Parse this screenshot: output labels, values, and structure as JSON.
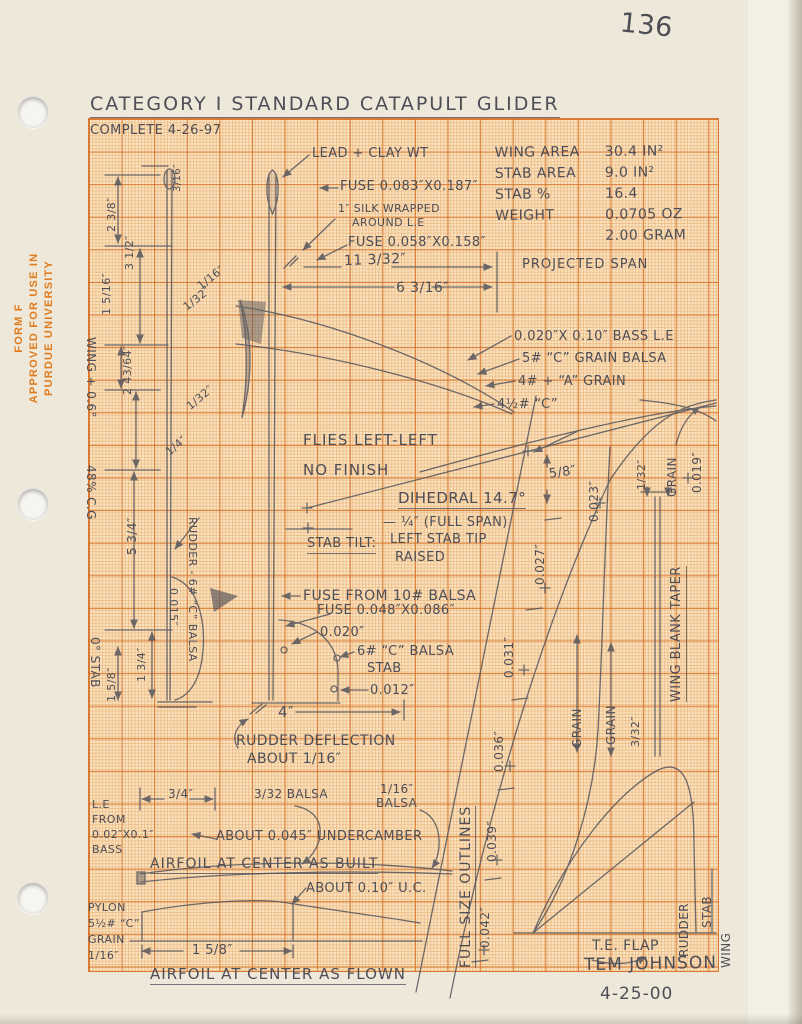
{
  "page": {
    "number": "136",
    "title": "CATEGORY I STANDARD CATAPULT GLIDER",
    "date_note": "COMPLETE 4-26-97",
    "signature": "TEM JOHNSON",
    "signature_date": "4-25-00"
  },
  "stamp": {
    "line1": "FORM F",
    "line2": "APPROVED FOR USE IN",
    "line3": "PURDUE UNIVERSITY"
  },
  "specs": {
    "rows": [
      {
        "label": "WING AREA",
        "value": "30.4 IN²"
      },
      {
        "label": "STAB AREA",
        "value": "9.0 IN²"
      },
      {
        "label": "STAB %",
        "value": "16.4"
      },
      {
        "label": "WEIGHT",
        "value": "0.0705 OZ"
      },
      {
        "label": "",
        "value": "2.00 GRAM"
      }
    ]
  },
  "notes": {
    "lead_clay": "LEAD + CLAY WT",
    "fuse_upper": "FUSE 0.083″X0.187″",
    "silk1": "1″ SILK WRAPPED",
    "silk2": "AROUND L.E",
    "fuse_lower": "FUSE 0.058″X0.158″",
    "span_total": "11 3/32″",
    "span_half": "6 3/16″",
    "projected_span": "PROJECTED SPAN",
    "bass_le": "0.020″X 0.10″ BASS L.E",
    "grain5": "5# “C” GRAIN BALSA",
    "grain4": "4# + “A” GRAIN",
    "grain45": "4½# “C”",
    "flies": "FLIES LEFT-LEFT",
    "finish": "NO FINISH",
    "dihedral": "DIHEDRAL 14.7°",
    "full_span": "— ¼″ (FULL SPAN)",
    "stab_tilt": "STAB TILT:",
    "stab_tilt2": "LEFT STAB TIP",
    "stab_tilt3": "RAISED",
    "fuse_10": "FUSE FROM 10# BALSA",
    "fuse_tail": "FUSE 0.048″X0.086″",
    "stab_balsa1": "6# “C” BALSA",
    "stab_balsa2": "STAB",
    "rudder_material": "RUDDER - 6# “C” BALSA",
    "rudder_defl1": "RUDDER DEFLECTION",
    "rudder_defl2": "ABOUT 1/16″",
    "wing_incidence": "WING + 0.6°",
    "cg": "48% C.G",
    "stab_incidence": "0° STAB",
    "wing_blank": "WING BLANK TAPER",
    "grain": "GRAIN",
    "full_size": "FULL SIZE OUTLINES",
    "te_flap": "T.E. FLAP",
    "rudder": "RUDDER",
    "stab": "STAB",
    "wing": "WING",
    "le1": "L.E",
    "le2": "FROM",
    "le3": "0.02″X0.1″",
    "le4": "BASS",
    "balsa332": "3/32 BALSA",
    "balsa116a": "1/16″",
    "balsa116b": "BALSA",
    "undercamber": "ABOUT 0.045″ UNDERCAMBER",
    "airfoil_built": "AIRFOIL AT CENTER AS BUILT",
    "pylon1": "PYLON",
    "pylon2": "5½# “C”",
    "pylon3": "GRAIN",
    "pylon4": "1/16″",
    "uc010": "ABOUT 0.10″ U.C.",
    "airfoil_flown": "AIRFOIL AT CENTER AS FLOWN"
  },
  "dims": {
    "tip_rise": "5/8″",
    "chord4": "4″",
    "t042": "0.042″",
    "t039": "0.039″",
    "t036": "0.036″",
    "t031": "0.031″",
    "t027": "0.027″",
    "t023": "0.023″",
    "t020": "0.020″",
    "t019": "0.019″",
    "t015": "0.015″",
    "t012": "0.012″",
    "f132": "1/32″",
    "f332": "3/32″",
    "f116": "1/16″",
    "f14": "1/4″",
    "f316": "3/16″",
    "f34": "3/4″",
    "d238": "2 3/8″",
    "d312": "3 1/2″",
    "d1516": "1 5/16″",
    "d24364": "2 43/64″",
    "d534": "5 3/4″",
    "d134": "1 3/4″",
    "d158": "1 5/8″"
  },
  "colors": {
    "pencil": "#4e4e57",
    "stamp": "#e07c1e",
    "grid_major": "#d56e23",
    "grid_minor": "#e28c3c",
    "paper": "#ede8da",
    "grid_bg": "#f8e2c0"
  }
}
